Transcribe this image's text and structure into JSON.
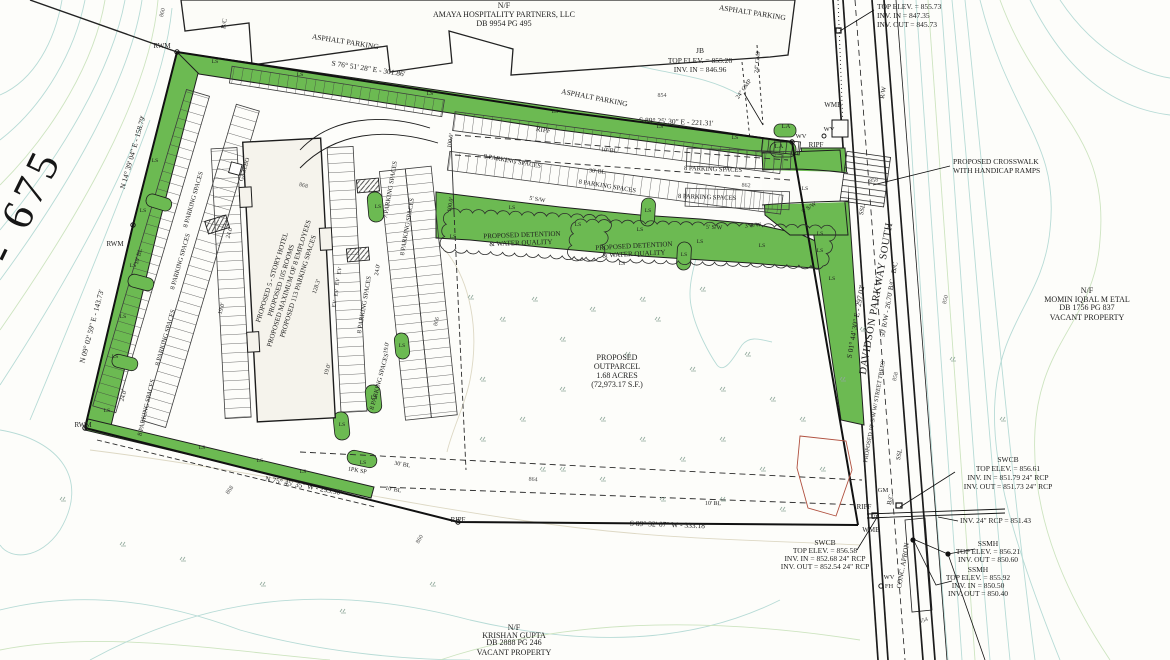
{
  "highway": {
    "label": "I - 675"
  },
  "amaya": {
    "nf": "N/F",
    "owner": "AMAYA HOSPITALITY PARTNERS, LLC",
    "deed": "DB 9954 PG 495"
  },
  "momin": {
    "nf": "N/F",
    "owner": "MOMIN IQBAL M ETAL",
    "deed": "DB 1756 PG 837",
    "status": "VACANT PROPERTY"
  },
  "krishan": {
    "nf": "N/F",
    "owner": "KRISHAN GUPTA",
    "deed": "DB 2888 PG 246",
    "status": "VACANT PROPERTY"
  },
  "labels": {
    "asphalt": "ASPHALT PARKING"
  },
  "road": {
    "name": "DAVIDSON PARKWAY SOUTH",
    "rw": "50' R/W  -  26.70' B/C - B/C",
    "sidewalk": "PROPOSED 10' S/W W/ STREET TREES",
    "conc_apron": "CONC. APRON"
  },
  "bearings": {
    "north1": "S 76° 51' 28\" E  -  301.86'",
    "north2": "S 89° 25' 30\" E  -  221.31'",
    "west1": "N 14° 39' 04\" E  -  158.79'",
    "west2": "N 09° 02' 59\" E  -  143.73'",
    "south1": "N 75° 45' 35\" W  -  293.90'",
    "south2": "S 89° 32' 07\" W  -  333.18'",
    "east1": "S 01° 44' 30\" E  -  297.02'"
  },
  "building": {
    "l1": "PROPOSED 5 - STORY HOTEL",
    "l2": "PROPOSED 105 ROOMS",
    "l3": "PROPOSED MAXIMUM OF 8 EMPLOYEES",
    "l4": "PROPOSED 113 PARKING SPACES",
    "len": "128.3'"
  },
  "outparcel": {
    "l1": "PROPOSED",
    "l2": "OUTPARCEL",
    "l3": "1.68 ACRES",
    "l4": "(72,973.17 S.F.)"
  },
  "detention": {
    "l1": "PROPOSED DETENTION",
    "l2": "& WATER QUALITY"
  },
  "callouts": {
    "inlet_ne": [
      "TOP ELEV. = 855.73",
      "INV. IN = 847.35",
      "INV. OUT = 845.73"
    ],
    "jb": [
      "JB",
      "TOP ELEV. = 855.26",
      "INV. IN = 846.96"
    ],
    "crosswalk": [
      "PROPOSED CROSSWALK",
      "WITH HANDICAP RAMPS"
    ],
    "swcb_ne": [
      "SWCB",
      "TOP ELEV. = 856.61",
      "INV. IN = 851.79 24\" RCP",
      "INV. OUT = 851.73 24\" RCP"
    ],
    "inv_rcp": "INV. 24\" RCP = 851.43",
    "ssmh_a": [
      "SSMH",
      "TOP ELEV. = 856.21",
      "INV. OUT = 850.60"
    ],
    "ssmh_b": [
      "SSMH",
      "TOP ELEV. = 855.92",
      "INV. IN = 850.50",
      "INV. OUT = 850.40"
    ],
    "swcb_w": [
      "SWCB",
      "TOP ELEV. = 856.58",
      "INV. IN = 852.68 24\" RCP",
      "INV. OUT = 852.54 24\" RCP"
    ]
  },
  "parking": {
    "eight": "8 PARKING SPACES",
    "seven": "7 PARKING SPACES",
    "one_pk": "1PK SP"
  },
  "dims": {
    "d24": "24.0'",
    "d19": "19.0'",
    "d100": "100.0'",
    "bl10": "10' BL",
    "bl30": "30' BL",
    "sw5": "5' S/W",
    "sw3": "3' S/W"
  },
  "markers": {
    "rwm": "RWM",
    "ripf": "RIPF",
    "wmb": "WMB",
    "wv": "WV",
    "fh": "FH",
    "la": "LA",
    "gm": "GM",
    "up": "UP",
    "bc": "B/C",
    "ssl": "SSL",
    "rw_label": "R/W",
    "ls": "LS",
    "ev": "EV",
    "cmp24": "24\" CMP",
    "gazebo": "GAZEBO"
  },
  "contour_labels": {
    "c850": "850",
    "c854": "854",
    "c858": "858",
    "c860": "860",
    "c862": "862",
    "c864": "864",
    "c866": "866",
    "c868": "868"
  },
  "colors": {
    "landscape_green": "#6cba52",
    "contour_cyan": "#b7dbd6",
    "contour_green": "#cde4c0",
    "line_black": "#1c1c1c",
    "red_feature": "#b0503f"
  }
}
